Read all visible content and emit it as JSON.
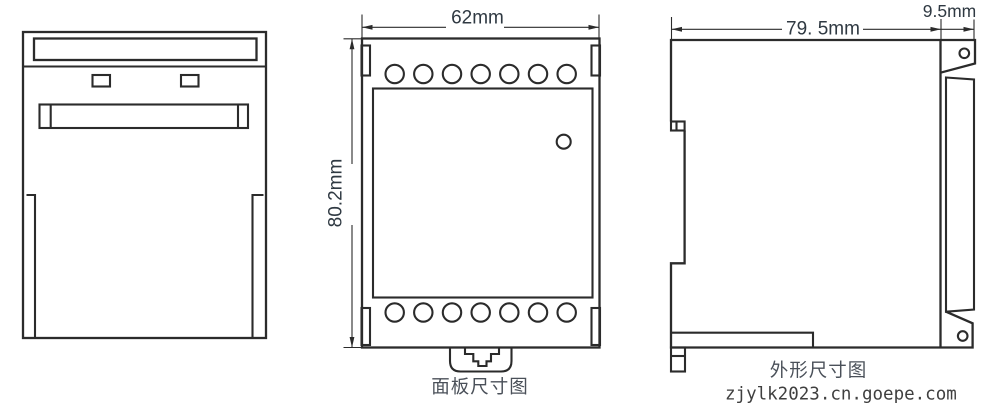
{
  "colors": {
    "line": "#2b2b2b",
    "dim_text": "#2f3942",
    "caption_text": "#4a5059",
    "watermark_text": "#3f3f3f",
    "background": "#ffffff"
  },
  "panel_view": {
    "width_label": "62mm",
    "height_label": "80.2mm",
    "caption": "面板尺寸图"
  },
  "outline_view": {
    "depth_label": "79. 5mm",
    "rail_label": "9.5mm",
    "caption": "外形尺寸图"
  },
  "watermark": "zjylk2023.cn.goepe.com"
}
